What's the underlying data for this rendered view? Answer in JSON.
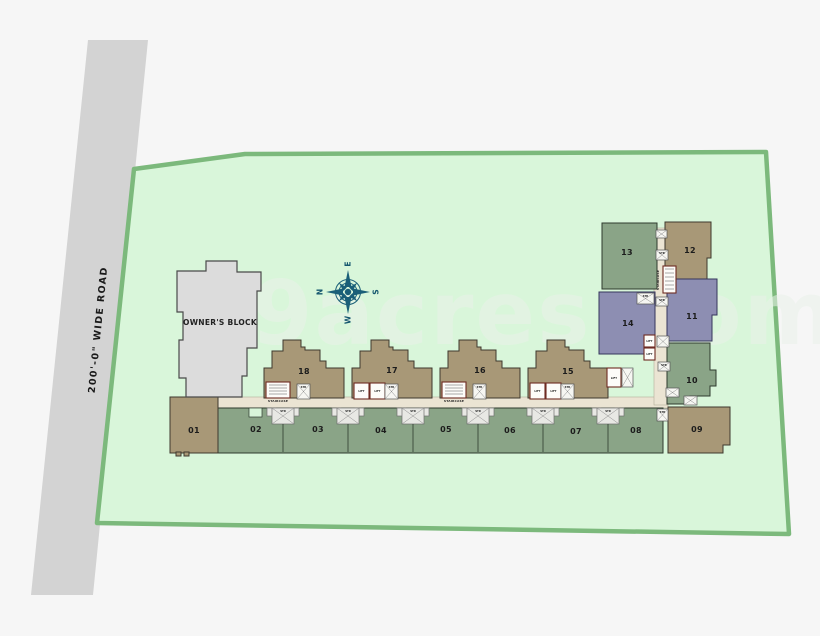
{
  "watermark": "99acres.com",
  "road_label": "200'-0\" WIDE ROAD",
  "owner_block_label": "OWNER'S BLOCK",
  "compass": {
    "n": "N",
    "e": "E",
    "s": "S",
    "w": "W"
  },
  "labels": {
    "str": "STR",
    "lift": "LIFT",
    "staircase": "STAIRCASE"
  },
  "blocks": {
    "b01": "01",
    "b02": "02",
    "b03": "03",
    "b04": "04",
    "b05": "05",
    "b06": "06",
    "b07": "07",
    "b08": "08",
    "b09": "09",
    "b10": "10",
    "b11": "11",
    "b12": "12",
    "b13": "13",
    "b14": "14",
    "b15": "15",
    "b16": "16",
    "b17": "17",
    "b18": "18"
  },
  "colors": {
    "background": "#f6f6f6",
    "road": "#d3d3d3",
    "site_fill": "#d9f6da",
    "site_border": "#7cb97c",
    "corridor": "#ebe4d3",
    "tan_block": "#a89877",
    "green_block": "#8aa487",
    "purple_block": "#8d8eb2",
    "owner_block": "#dcdcdc",
    "compass": "#1a5f78"
  }
}
